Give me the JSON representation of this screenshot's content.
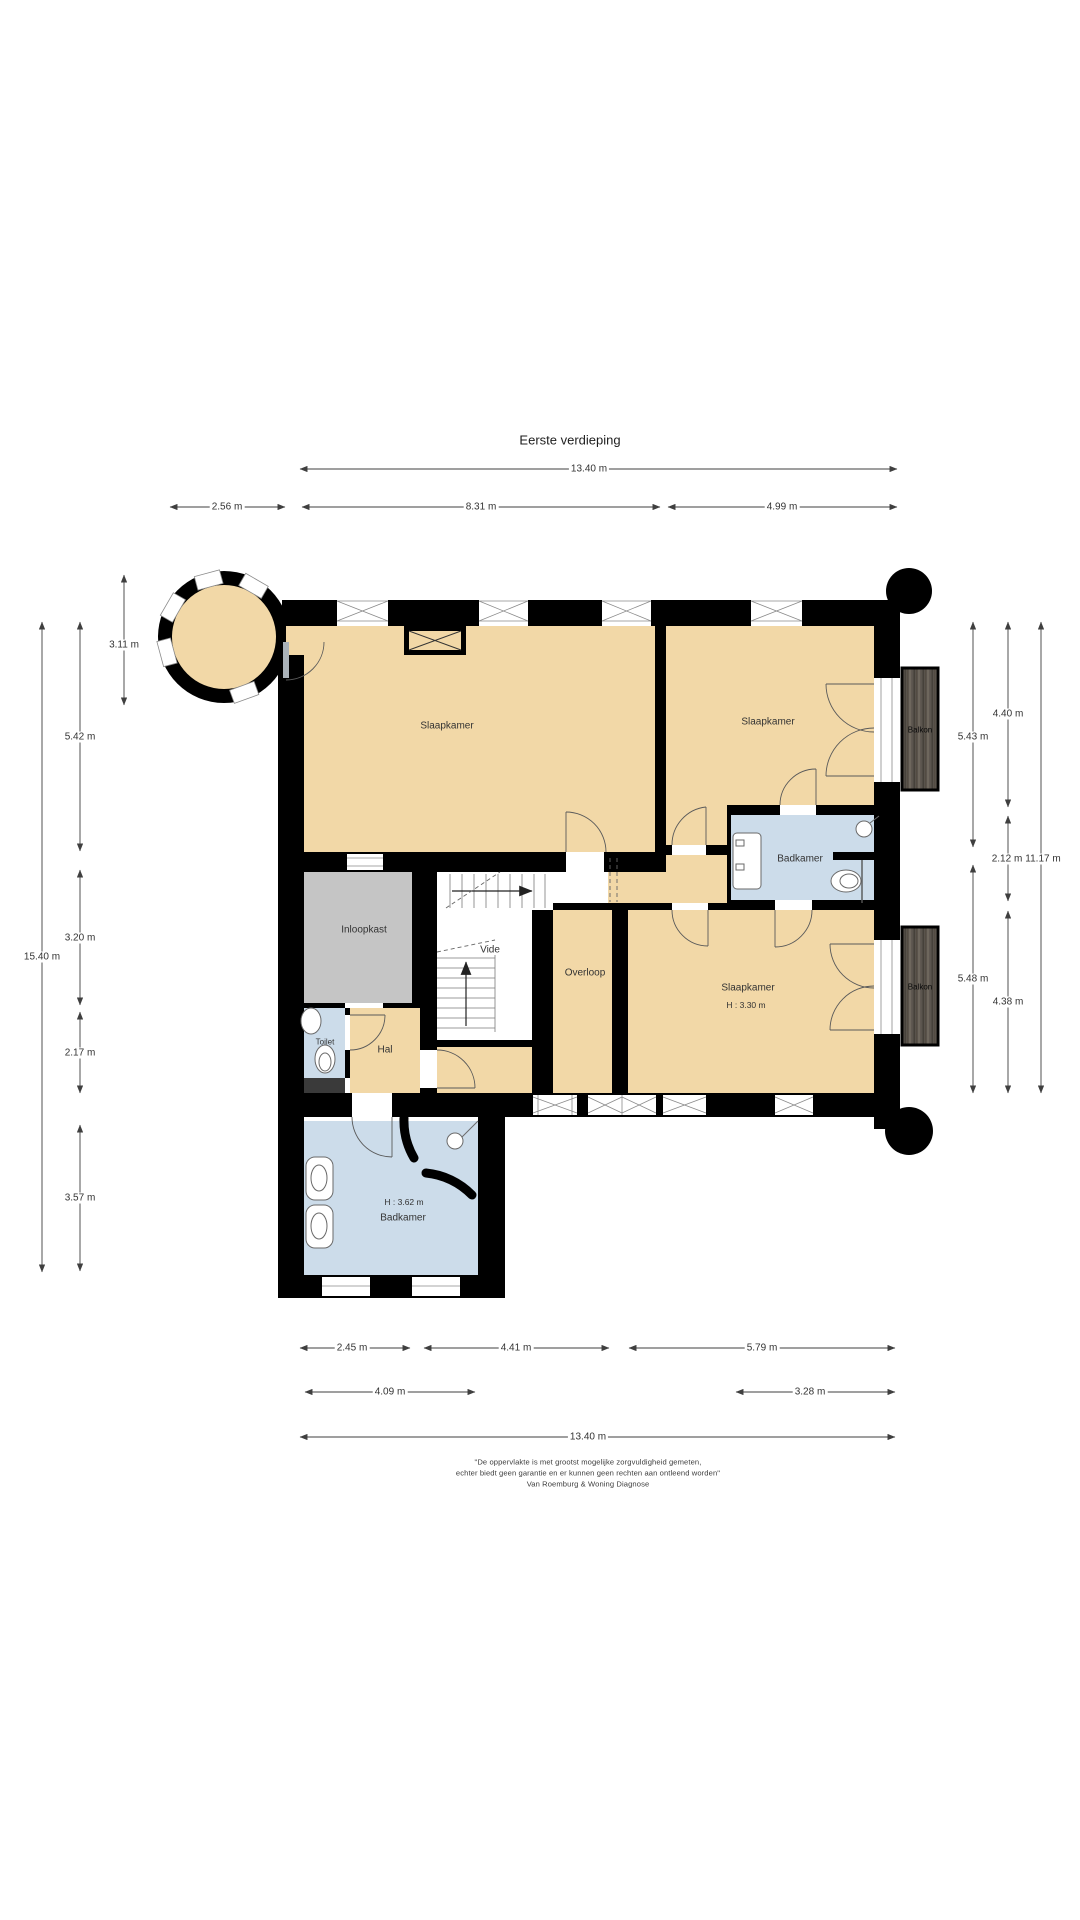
{
  "title": "Eerste verdieping",
  "rooms": {
    "bedroom_large": "Slaapkamer",
    "bedroom_topright": "Slaapkamer",
    "bedroom_bottom": "Slaapkamer",
    "bedroom_bottom_height": "H : 3.30 m",
    "bathroom_right": "Badkamer",
    "bathroom_bottom": "Badkamer",
    "bathroom_bottom_height": "H : 3.62 m",
    "walk_in_closet": "Inloopkast",
    "landing": "Overloop",
    "void": "Vide",
    "toilet": "Toilet",
    "hall": "Hal",
    "balcony_top": "Balkon",
    "balcony_bottom": "Balkon"
  },
  "dimensions": {
    "top": [
      "13.40 m",
      "2.56 m",
      "8.31 m",
      "4.99 m"
    ],
    "left": [
      "15.40 m",
      "5.42 m",
      "3.20 m",
      "2.17 m",
      "3.57 m",
      "3.11 m"
    ],
    "right": [
      "5.43 m",
      "5.48 m",
      "4.40 m",
      "2.12 m",
      "4.38 m",
      "11.17 m"
    ],
    "bottom": [
      "2.45 m",
      "4.41 m",
      "5.79 m",
      "4.09 m",
      "3.28 m",
      "13.40 m"
    ]
  },
  "footer": {
    "line1": "\"De oppervlakte is met grootst mogelijke zorgvuldigheid gemeten,",
    "line2": "echter biedt geen garantie en er kunnen geen rechten aan ontleend worden\"",
    "line3": "Van Roemburg & Woning Diagnose"
  },
  "colors": {
    "floor": "#f2d8a7",
    "wet_room": "#ccdcea",
    "closet": "#c5c5c5",
    "wall": "#000000",
    "balcony_wood": "#5b554e",
    "step_dark": "#3a3a3a"
  }
}
